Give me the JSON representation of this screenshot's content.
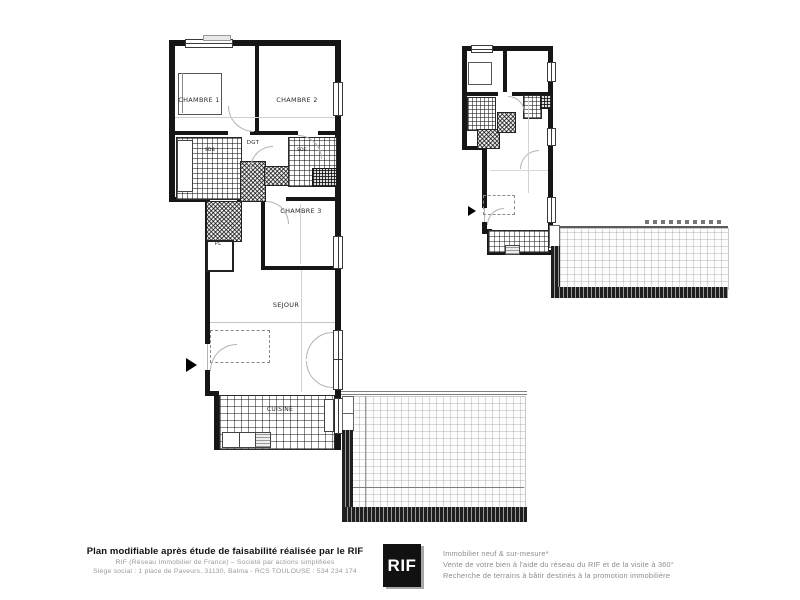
{
  "plan": {
    "labels": {
      "chambre1": "CHAMBRE 1",
      "chambre2": "CHAMBRE 2",
      "chambre3": "CHAMBRE 3",
      "degagement": "DGT",
      "sdb": "SDB",
      "sde": "SDE",
      "placard": "PL",
      "sejour": "SEJOUR",
      "cuisine": "CUISINE",
      "terrasse": "TERRASSE"
    }
  },
  "footer": {
    "left": {
      "line1": "Plan modifiable après étude de faisabilité réalisée par le RIF",
      "line2": "RIF (Réseau Immobilier de France) – Société par actions simplifiées",
      "line3": "Siège social : 1 place de Paveurs, 31130, Balma - RCS TOULOUSE : 534 234 174"
    },
    "logo": {
      "text": "RIF"
    },
    "right": {
      "line1": "Immobilier neuf & sur-mesure*",
      "line2": "Vente de votre bien à l'aide du réseau du RIF et de la visite à 360°",
      "line3": "Recherche de terrains à bâtir destinés à la promotion immobilière"
    }
  },
  "colors": {
    "wall": "#161616",
    "logo_bg": "#111111",
    "logo_text": "#ffffff",
    "footer_gray": "#9a9a9a"
  }
}
